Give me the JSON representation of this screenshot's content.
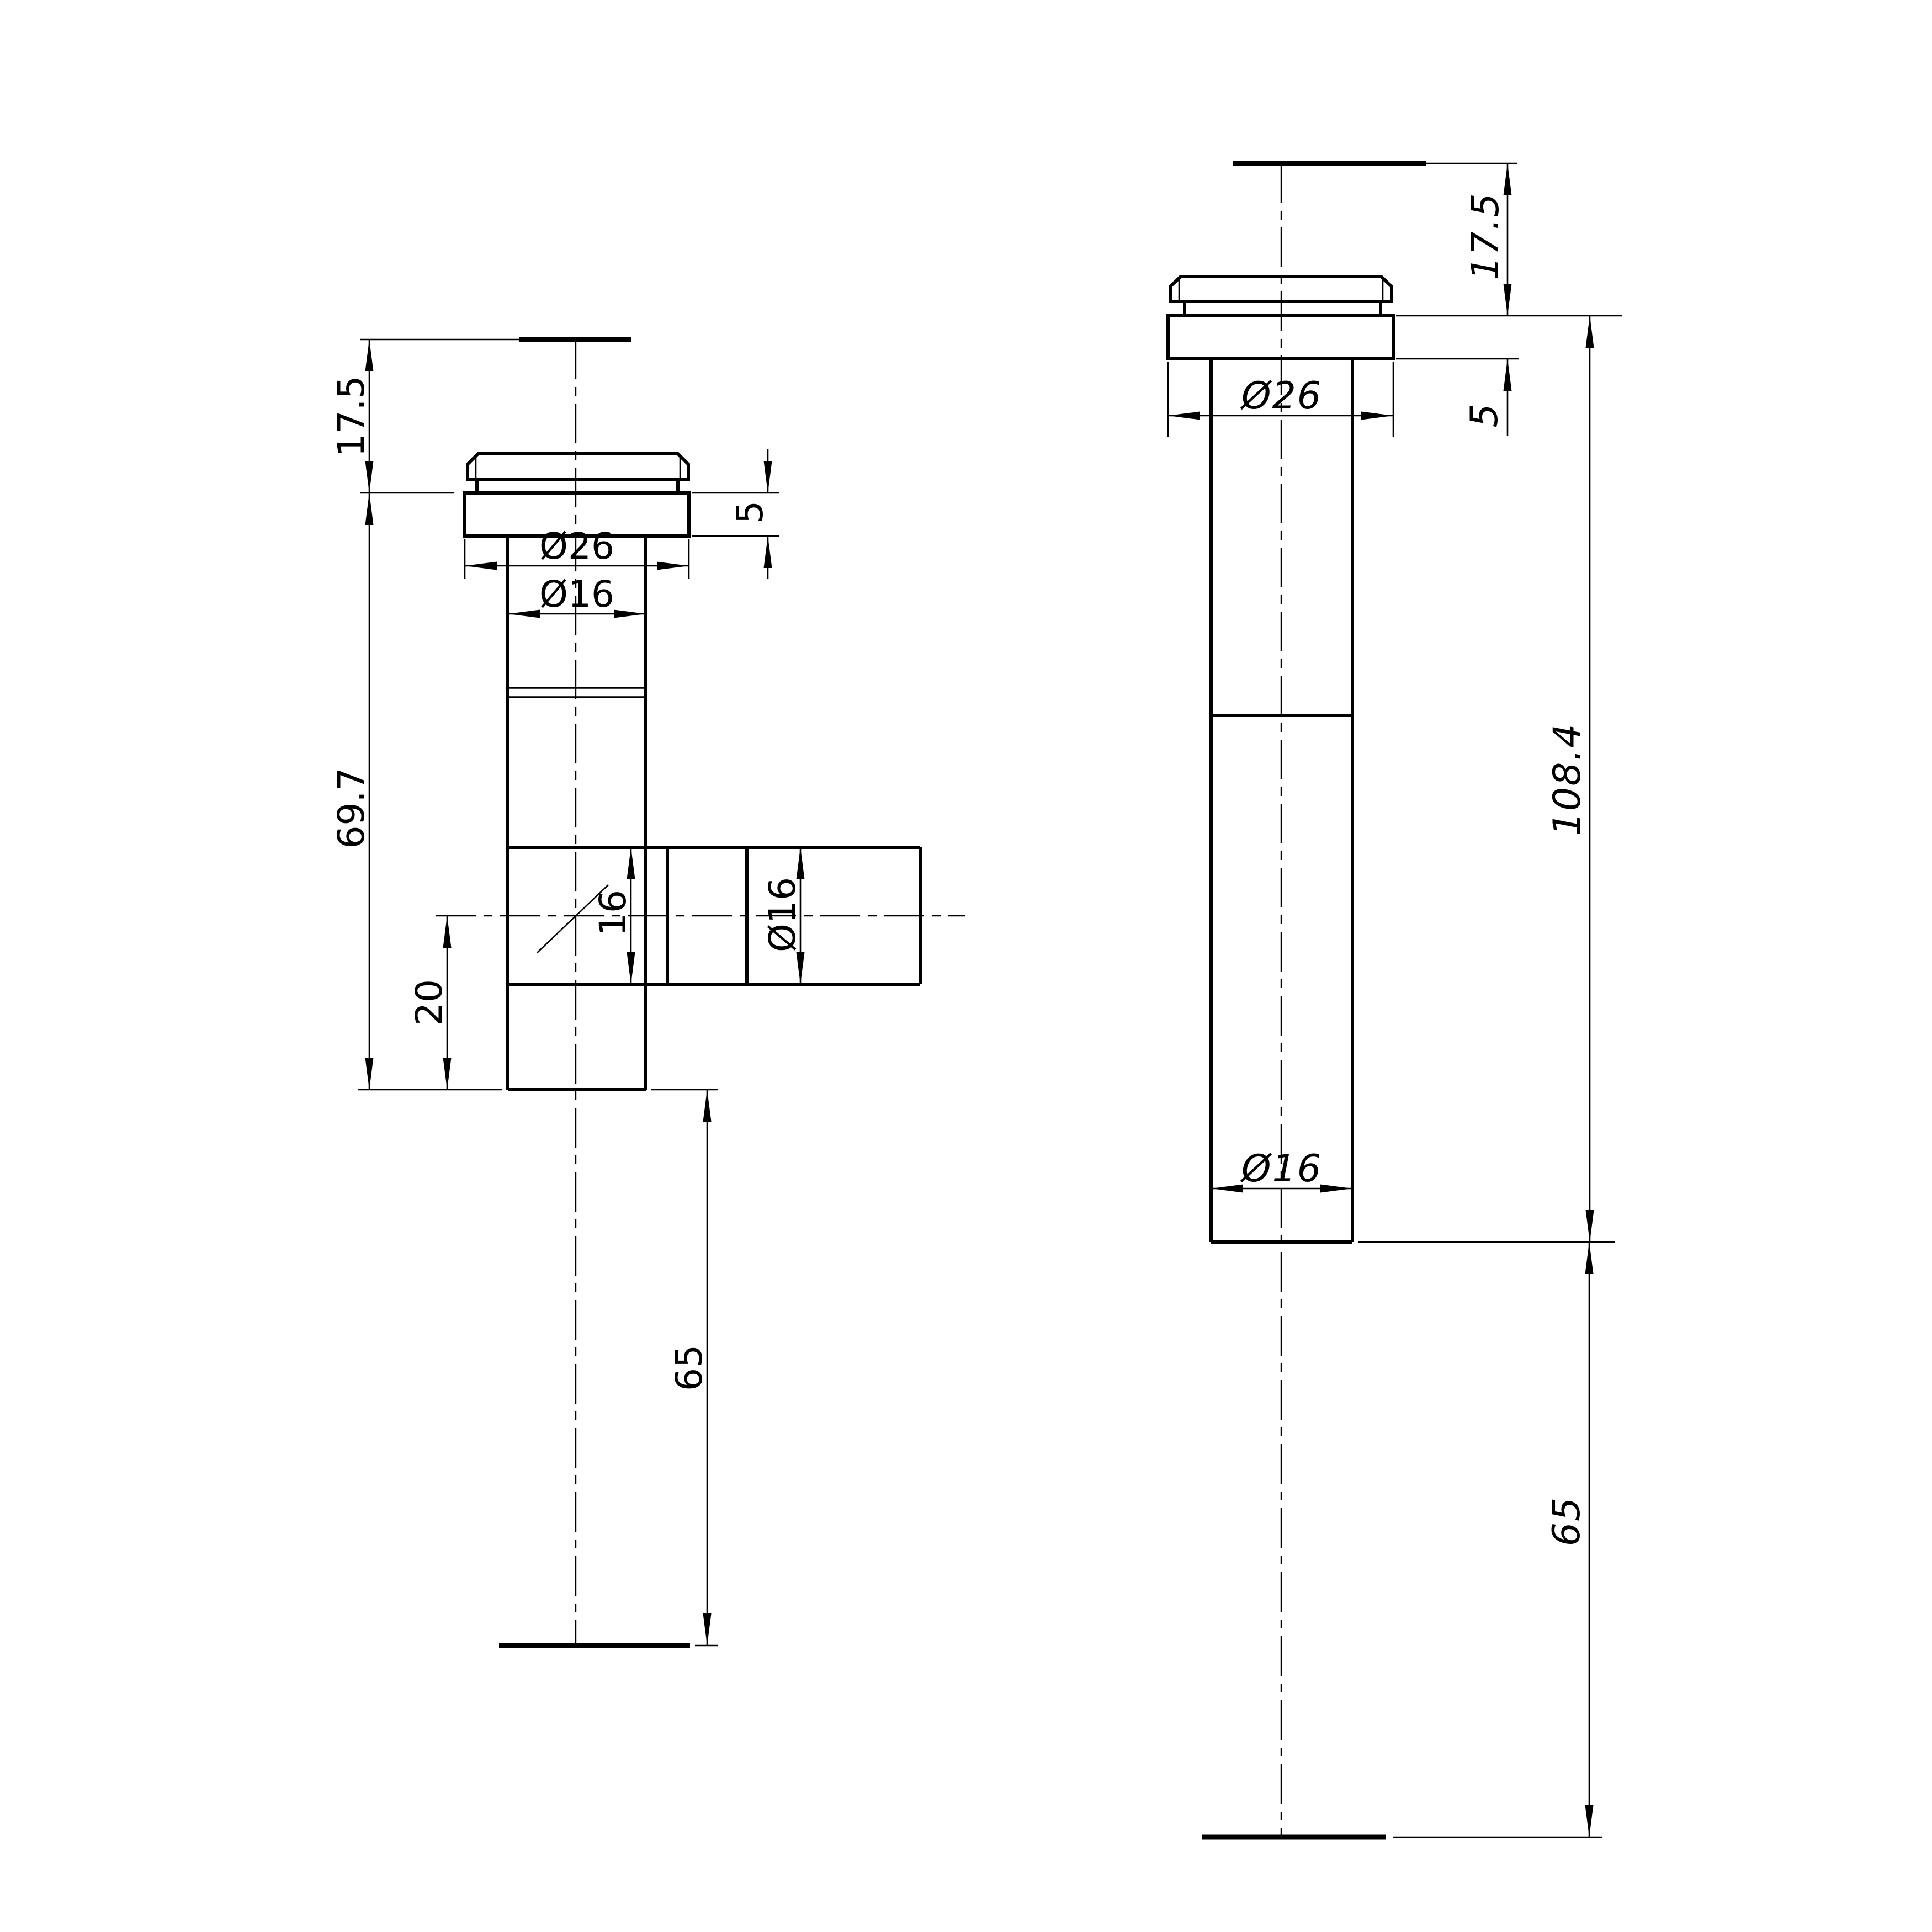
{
  "drawing": {
    "type": "technical-drawing",
    "colors": {
      "line": "#000000",
      "background": "#ffffff"
    },
    "left_view": {
      "name": "tee-body-front-view",
      "dim_labels": {
        "top_height": "17.5",
        "cap_to_flange_gap": "5",
        "flange_diameter": "Ø26",
        "tube_diameter": "Ø16",
        "body_length": "69.7",
        "branch_bore": "16",
        "branch_diameter": "Ø16",
        "branch_center_offset": "20",
        "tail_length": "65"
      }
    },
    "right_view": {
      "name": "straight-body-side-view",
      "dim_labels": {
        "top_height": "17.5",
        "flange_thickness": "5",
        "flange_diameter": "Ø26",
        "overall_length": "108.4",
        "tube_diameter": "Ø16",
        "tail_length": "65"
      }
    }
  }
}
